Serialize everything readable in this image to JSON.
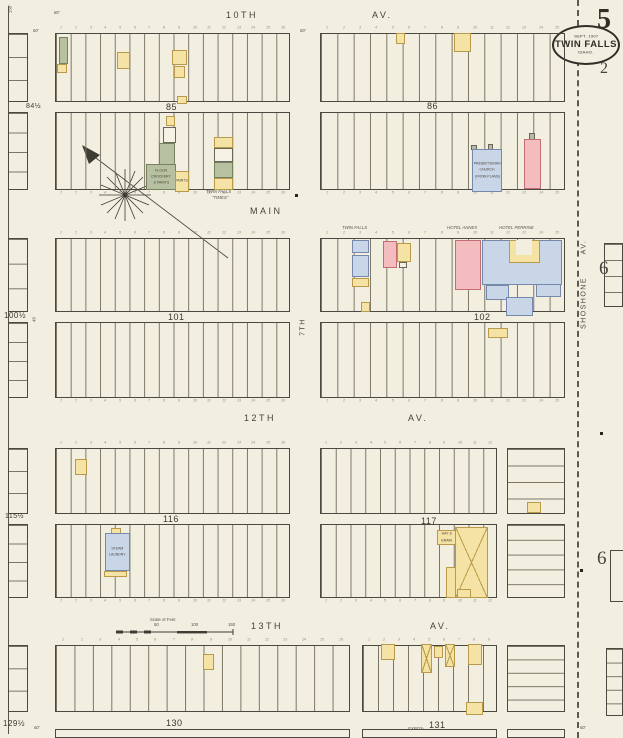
{
  "sheet": {
    "big_number": "5",
    "adjacent_number_below_seal": "2",
    "adjacent_numbers_right": [
      "6",
      "6"
    ],
    "seal": {
      "line1": "SEPT. 1907",
      "line2": "TWIN FALLS",
      "line3": "IDAHO."
    }
  },
  "palette": {
    "paper": "#f2efe1",
    "line": "#4b4941",
    "lot_line": "#7b7666",
    "yellow": {
      "fill": "#f4e3a4",
      "border": "#b99a4a"
    },
    "pink": {
      "fill": "#f3bdc0",
      "border": "#c06d74"
    },
    "blue": {
      "fill": "#c9d6e8",
      "border": "#7489ab"
    },
    "olive": {
      "fill": "#b7c1a2",
      "border": "#75815f"
    },
    "white": {
      "fill": "#f6f3e6",
      "border": "#6b6758"
    },
    "gray": {
      "fill": "#b9b7ac",
      "border": "#6b6758"
    },
    "court": {
      "fill": "#f2efe1",
      "border": "transparent"
    }
  },
  "street_labels": [
    {
      "text": "10TH",
      "x": 226,
      "y": 10
    },
    {
      "text": "AV.",
      "x": 372,
      "y": 10
    },
    {
      "text": "MAIN",
      "x": 250,
      "y": 206
    },
    {
      "text": "12TH",
      "x": 244,
      "y": 413
    },
    {
      "text": "AV.",
      "x": 408,
      "y": 413
    },
    {
      "text": "13TH",
      "x": 251,
      "y": 621
    },
    {
      "text": "AV.",
      "x": 430,
      "y": 621
    },
    {
      "text": "SHOSHONE",
      "x": 584,
      "y": 303,
      "rot": -90
    },
    {
      "text": "AV.",
      "x": 584,
      "y": 247,
      "rot": -90
    },
    {
      "text": "7TH",
      "x": 303,
      "y": 327,
      "rot": -90
    }
  ],
  "block_numbers": [
    {
      "text": "84½",
      "x": 26,
      "y": 103,
      "size": 7
    },
    {
      "text": "85",
      "x": 166,
      "y": 102,
      "size": 9
    },
    {
      "text": "86",
      "x": 427,
      "y": 101,
      "size": 9
    },
    {
      "text": "100½",
      "x": 4,
      "y": 311,
      "size": 8
    },
    {
      "text": "101",
      "x": 168,
      "y": 312,
      "size": 9
    },
    {
      "text": "102",
      "x": 474,
      "y": 312,
      "size": 9
    },
    {
      "text": "115½",
      "x": 5,
      "y": 513,
      "size": 7
    },
    {
      "text": "116",
      "x": 163,
      "y": 514,
      "size": 9
    },
    {
      "text": "117",
      "x": 421,
      "y": 516,
      "size": 9
    },
    {
      "text": "129½",
      "x": 3,
      "y": 719,
      "size": 8
    },
    {
      "text": "130",
      "x": 166,
      "y": 718,
      "size": 9
    },
    {
      "text": "131",
      "x": 429,
      "y": 720,
      "size": 9
    }
  ],
  "blocks": [
    {
      "x": 55,
      "y": 33,
      "w": 235,
      "h": 69,
      "lots": 16,
      "dir": "v",
      "numbers": "top"
    },
    {
      "x": 55,
      "y": 112,
      "w": 235,
      "h": 78,
      "lots": 16,
      "dir": "v",
      "numbers": "bottom"
    },
    {
      "x": 320,
      "y": 33,
      "w": 245,
      "h": 69,
      "lots": 15,
      "dir": "v",
      "numbers": "top"
    },
    {
      "x": 320,
      "y": 112,
      "w": 245,
      "h": 78,
      "lots": 15,
      "dir": "v",
      "numbers": "bottom"
    },
    {
      "x": 55,
      "y": 238,
      "w": 235,
      "h": 74,
      "lots": 16,
      "dir": "v",
      "numbers": "top"
    },
    {
      "x": 55,
      "y": 322,
      "w": 235,
      "h": 76,
      "lots": 16,
      "dir": "v",
      "numbers": "bottom"
    },
    {
      "x": 320,
      "y": 238,
      "w": 245,
      "h": 74,
      "lots": 15,
      "dir": "v",
      "numbers": "top"
    },
    {
      "x": 320,
      "y": 322,
      "w": 245,
      "h": 76,
      "lots": 15,
      "dir": "v",
      "numbers": "bottom"
    },
    {
      "x": 55,
      "y": 448,
      "w": 235,
      "h": 66,
      "lots": 16,
      "dir": "v",
      "numbers": "top"
    },
    {
      "x": 55,
      "y": 524,
      "w": 235,
      "h": 74,
      "lots": 16,
      "dir": "v",
      "numbers": "bottom"
    },
    {
      "x": 320,
      "y": 448,
      "w": 177,
      "h": 66,
      "lots": 12,
      "dir": "v",
      "numbers": "top"
    },
    {
      "x": 320,
      "y": 524,
      "w": 177,
      "h": 74,
      "lots": 12,
      "dir": "v",
      "numbers": "bottom"
    },
    {
      "x": 507,
      "y": 448,
      "w": 58,
      "h": 66,
      "lots": 4,
      "dir": "h"
    },
    {
      "x": 507,
      "y": 524,
      "w": 58,
      "h": 74,
      "lots": 5,
      "dir": "h"
    },
    {
      "x": 55,
      "y": 645,
      "w": 295,
      "h": 67,
      "lots": 16,
      "dir": "v",
      "numbers": "top"
    },
    {
      "x": 362,
      "y": 645,
      "w": 135,
      "h": 67,
      "lots": 9,
      "dir": "v",
      "numbers": "top"
    },
    {
      "x": 507,
      "y": 645,
      "w": 58,
      "h": 67,
      "lots": 5,
      "dir": "h"
    },
    {
      "x": 8,
      "y": 33,
      "w": 20,
      "h": 69,
      "lots": 3,
      "dir": "h"
    },
    {
      "x": 8,
      "y": 112,
      "w": 20,
      "h": 78,
      "lots": 4,
      "dir": "h"
    },
    {
      "x": 8,
      "y": 238,
      "w": 20,
      "h": 74,
      "lots": 3,
      "dir": "h"
    },
    {
      "x": 8,
      "y": 322,
      "w": 20,
      "h": 76,
      "lots": 4,
      "dir": "h"
    },
    {
      "x": 8,
      "y": 448,
      "w": 20,
      "h": 66,
      "lots": 3,
      "dir": "h"
    },
    {
      "x": 8,
      "y": 524,
      "w": 20,
      "h": 74,
      "lots": 4,
      "dir": "h"
    },
    {
      "x": 8,
      "y": 645,
      "w": 20,
      "h": 67,
      "lots": 3,
      "dir": "h"
    },
    {
      "x": 604,
      "y": 243,
      "w": 19,
      "h": 64,
      "lots": 4,
      "dir": "h"
    },
    {
      "x": 610,
      "y": 550,
      "w": 13,
      "h": 52,
      "lots": 0,
      "dir": "h",
      "open": "Right"
    },
    {
      "x": 606,
      "y": 648,
      "w": 17,
      "h": 68,
      "lots": 5,
      "dir": "h"
    },
    {
      "x": 55,
      "y": 729,
      "w": 295,
      "h": 9,
      "lots": 0,
      "dir": "v"
    },
    {
      "x": 362,
      "y": 729,
      "w": 135,
      "h": 9,
      "lots": 0,
      "dir": "v"
    },
    {
      "x": 507,
      "y": 729,
      "w": 58,
      "h": 9,
      "lots": 0,
      "dir": "v"
    }
  ],
  "buildings": [
    {
      "x": 59,
      "y": 37,
      "w": 9,
      "h": 27,
      "color": "olive"
    },
    {
      "x": 57,
      "y": 64,
      "w": 10,
      "h": 9,
      "color": "yellow"
    },
    {
      "x": 117,
      "y": 52,
      "w": 13,
      "h": 17,
      "color": "yellow"
    },
    {
      "x": 172,
      "y": 50,
      "w": 15,
      "h": 15,
      "color": "yellow"
    },
    {
      "x": 174,
      "y": 66,
      "w": 11,
      "h": 12,
      "color": "yellow"
    },
    {
      "x": 177,
      "y": 96,
      "w": 10,
      "h": 8,
      "color": "yellow"
    },
    {
      "x": 396,
      "y": 33,
      "w": 9,
      "h": 11,
      "color": "yellow"
    },
    {
      "x": 454,
      "y": 33,
      "w": 17,
      "h": 19,
      "color": "yellow"
    },
    {
      "x": 166,
      "y": 116,
      "w": 9,
      "h": 10,
      "color": "yellow"
    },
    {
      "x": 163,
      "y": 127,
      "w": 13,
      "h": 16,
      "color": "white"
    },
    {
      "x": 159,
      "y": 143,
      "w": 16,
      "h": 22,
      "color": "olive"
    },
    {
      "x": 146,
      "y": 164,
      "w": 30,
      "h": 26,
      "color": "olive",
      "label": [
        "FLOUR",
        "CROCKERY",
        "& PAINTS"
      ]
    },
    {
      "x": 175,
      "y": 171,
      "w": 14,
      "h": 21,
      "color": "yellow",
      "label": [
        "PAINTS"
      ]
    },
    {
      "x": 214,
      "y": 137,
      "w": 19,
      "h": 11,
      "color": "yellow"
    },
    {
      "x": 214,
      "y": 148,
      "w": 19,
      "h": 14,
      "color": "white"
    },
    {
      "x": 214,
      "y": 162,
      "w": 19,
      "h": 16,
      "color": "olive"
    },
    {
      "x": 214,
      "y": 178,
      "w": 19,
      "h": 12,
      "color": "yellow"
    },
    {
      "x": 471,
      "y": 145,
      "w": 6,
      "h": 5,
      "color": "gray"
    },
    {
      "x": 488,
      "y": 144,
      "w": 5,
      "h": 6,
      "color": "gray"
    },
    {
      "x": 472,
      "y": 149,
      "w": 30,
      "h": 43,
      "color": "blue",
      "label": [
        "PRESBYTERIAN",
        "CHURCH",
        "(FROM PLANS)"
      ]
    },
    {
      "x": 529,
      "y": 133,
      "w": 6,
      "h": 7,
      "color": "gray"
    },
    {
      "x": 524,
      "y": 139,
      "w": 17,
      "h": 50,
      "color": "pink"
    },
    {
      "x": 352,
      "y": 240,
      "w": 17,
      "h": 13,
      "color": "blue"
    },
    {
      "x": 352,
      "y": 255,
      "w": 17,
      "h": 22,
      "color": "blue"
    },
    {
      "x": 352,
      "y": 278,
      "w": 17,
      "h": 9,
      "color": "yellow"
    },
    {
      "x": 383,
      "y": 241,
      "w": 14,
      "h": 27,
      "color": "pink"
    },
    {
      "x": 397,
      "y": 243,
      "w": 14,
      "h": 19,
      "color": "yellow"
    },
    {
      "x": 399,
      "y": 262,
      "w": 8,
      "h": 6,
      "color": "white"
    },
    {
      "x": 361,
      "y": 302,
      "w": 9,
      "h": 10,
      "color": "yellow"
    },
    {
      "x": 455,
      "y": 240,
      "w": 26,
      "h": 50,
      "color": "pink"
    },
    {
      "x": 482,
      "y": 240,
      "w": 80,
      "h": 45,
      "color": "blue"
    },
    {
      "x": 509,
      "y": 240,
      "w": 31,
      "h": 23,
      "color": "yellow"
    },
    {
      "x": 516,
      "y": 240,
      "w": 16,
      "h": 15,
      "color": "court"
    },
    {
      "x": 486,
      "y": 285,
      "w": 23,
      "h": 15,
      "color": "blue"
    },
    {
      "x": 506,
      "y": 297,
      "w": 27,
      "h": 19,
      "color": "blue"
    },
    {
      "x": 536,
      "y": 284,
      "w": 25,
      "h": 13,
      "color": "blue"
    },
    {
      "x": 488,
      "y": 328,
      "w": 20,
      "h": 10,
      "color": "yellow"
    },
    {
      "x": 75,
      "y": 459,
      "w": 12,
      "h": 16,
      "color": "yellow"
    },
    {
      "x": 111,
      "y": 528,
      "w": 10,
      "h": 6,
      "color": "yellow"
    },
    {
      "x": 105,
      "y": 533,
      "w": 25,
      "h": 38,
      "color": "blue",
      "label": [
        "STEAM",
        "LAUNDRY"
      ]
    },
    {
      "x": 104,
      "y": 571,
      "w": 23,
      "h": 6,
      "color": "yellow"
    },
    {
      "x": 437,
      "y": 530,
      "w": 19,
      "h": 15,
      "color": "yellow",
      "label": [
        "HAY &",
        "GRAIN"
      ]
    },
    {
      "x": 455,
      "y": 527,
      "w": 33,
      "h": 71,
      "color": "yellow",
      "cross": true
    },
    {
      "x": 446,
      "y": 567,
      "w": 10,
      "h": 31,
      "color": "yellow"
    },
    {
      "x": 457,
      "y": 589,
      "w": 14,
      "h": 9,
      "color": "yellow"
    },
    {
      "x": 527,
      "y": 502,
      "w": 14,
      "h": 11,
      "color": "yellow"
    },
    {
      "x": 203,
      "y": 654,
      "w": 11,
      "h": 16,
      "color": "yellow"
    },
    {
      "x": 381,
      "y": 644,
      "w": 14,
      "h": 16,
      "color": "yellow"
    },
    {
      "x": 421,
      "y": 644,
      "w": 11,
      "h": 29,
      "color": "yellow",
      "cross": true
    },
    {
      "x": 434,
      "y": 646,
      "w": 9,
      "h": 12,
      "color": "yellow"
    },
    {
      "x": 445,
      "y": 644,
      "w": 10,
      "h": 23,
      "color": "yellow",
      "cross": true
    },
    {
      "x": 468,
      "y": 644,
      "w": 14,
      "h": 21,
      "color": "yellow"
    },
    {
      "x": 466,
      "y": 702,
      "w": 17,
      "h": 13,
      "color": "yellow"
    }
  ],
  "notes": [
    {
      "text": "TWIN FALLS",
      "x": 206,
      "y": 190
    },
    {
      "text": "\"TIMES\"",
      "x": 212,
      "y": 196
    },
    {
      "text": "TWIN FALLS",
      "x": 342,
      "y": 226
    },
    {
      "text": "HOTEL ANNEX",
      "x": 447,
      "y": 226
    },
    {
      "text": "HOTEL PERRINE",
      "x": 499,
      "y": 226
    },
    {
      "text": "EXPOS-",
      "x": 408,
      "y": 727
    },
    {
      "text": "60'",
      "x": 33,
      "y": 29
    },
    {
      "text": "80'",
      "x": 54,
      "y": 11
    },
    {
      "text": "60'",
      "x": 300,
      "y": 29
    },
    {
      "text": "150'",
      "x": 14,
      "y": 16,
      "rot": -90
    },
    {
      "text": "49",
      "x": 36,
      "y": 325,
      "rot": -90
    },
    {
      "text": "60'",
      "x": 34,
      "y": 726
    },
    {
      "text": "60'",
      "x": 580,
      "y": 726
    }
  ],
  "scale_bar": {
    "title": "Scale of Feet",
    "ticks": [
      {
        "label": "50",
        "x": 154
      },
      {
        "label": "100",
        "x": 191
      },
      {
        "label": "150",
        "x": 228
      }
    ]
  },
  "markers": [
    {
      "x": 295,
      "y": 194
    },
    {
      "x": 580,
      "y": 569
    },
    {
      "x": 600,
      "y": 432
    }
  ]
}
